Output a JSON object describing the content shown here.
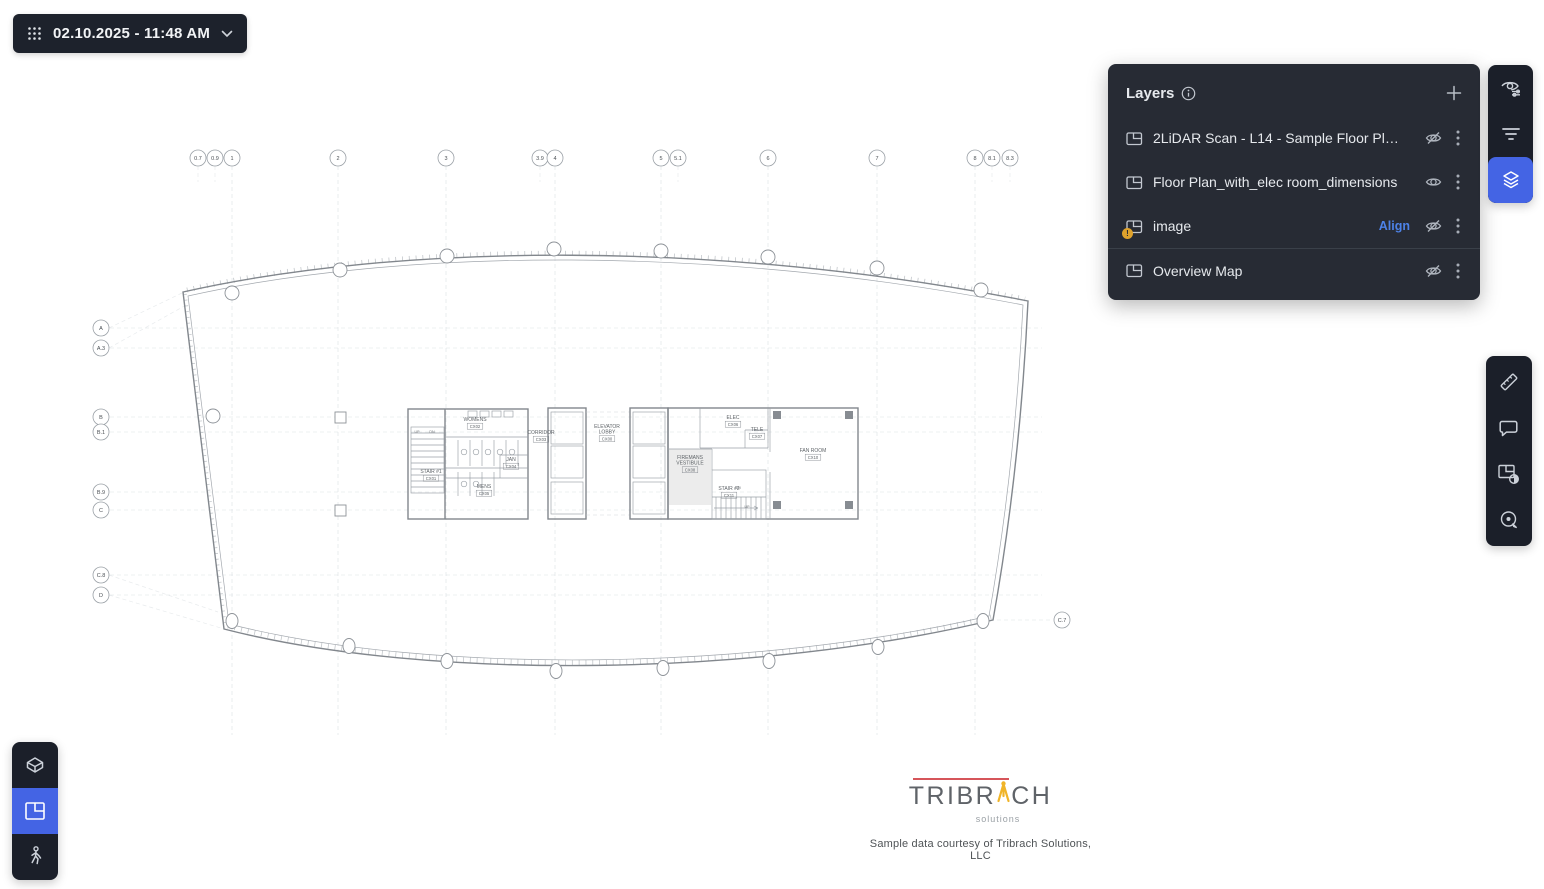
{
  "datebar": {
    "label": "02.10.2025 - 11:48 AM",
    "grid_icon": "grid-dots-icon",
    "chevron_icon": "chevron-down-icon"
  },
  "layers_panel": {
    "title": "Layers",
    "info_icon": "info-icon",
    "add_icon": "plus-icon",
    "items": [
      {
        "name": "2LiDAR Scan - L14 - Sample Floor Plan.76",
        "visible": false
      },
      {
        "name": "Floor Plan_with_elec room_dimensions",
        "visible": true
      },
      {
        "name": "image",
        "visible": false,
        "warning": true,
        "action_label": "Align"
      },
      {
        "name": "Overview Map",
        "visible": false
      }
    ]
  },
  "right_toolbar_top": {
    "items": [
      {
        "icon": "view-settings-icon",
        "active": false
      },
      {
        "icon": "filter-icon",
        "active": false
      },
      {
        "icon": "layers-icon",
        "active": true
      }
    ]
  },
  "right_toolbar_tools": {
    "items": [
      {
        "icon": "measure-icon"
      },
      {
        "icon": "comment-icon"
      },
      {
        "icon": "compare-icon"
      },
      {
        "icon": "annotate-icon"
      }
    ]
  },
  "left_toolbar": {
    "items": [
      {
        "icon": "view-3d-icon",
        "active": false
      },
      {
        "icon": "floor-plan-icon",
        "active": true
      },
      {
        "icon": "walkthrough-icon",
        "active": false
      }
    ]
  },
  "logo": {
    "brand_left": "TRIBR",
    "brand_right": "CH",
    "sub": "solutions",
    "caption": "Sample data courtesy of Tribrach Solutions, LLC",
    "tripod_icon": "tripod-icon"
  },
  "colors": {
    "accent_blue": "#4464e4",
    "warning_amber": "#dfa22c",
    "align_link": "#4d82e8",
    "panel_dark": "#272b34",
    "toolbar_dark": "#1b1f29"
  },
  "floorplan": {
    "top_bubble_y": 158,
    "left_bubble_x": 101,
    "grid_top": [
      {
        "label": "0.7",
        "x": 198
      },
      {
        "label": "0.9",
        "x": 215
      },
      {
        "label": "1",
        "x": 232
      },
      {
        "label": "2",
        "x": 338
      },
      {
        "label": "3",
        "x": 446
      },
      {
        "label": "3.9",
        "x": 540
      },
      {
        "label": "4",
        "x": 555
      },
      {
        "label": "5",
        "x": 661
      },
      {
        "label": "5.1",
        "x": 678
      },
      {
        "label": "6",
        "x": 768
      },
      {
        "label": "7",
        "x": 877
      },
      {
        "label": "8",
        "x": 975
      },
      {
        "label": "8.1",
        "x": 992
      },
      {
        "label": "8.3",
        "x": 1010
      }
    ],
    "grid_left": [
      {
        "label": "A",
        "y": 328
      },
      {
        "label": "A.3",
        "y": 348
      },
      {
        "label": "B",
        "y": 417
      },
      {
        "label": "B.1",
        "y": 432
      },
      {
        "label": "B.9",
        "y": 492
      },
      {
        "label": "C",
        "y": 510
      },
      {
        "label": "C.8",
        "y": 575
      },
      {
        "label": "D",
        "y": 595
      }
    ],
    "extra_bubble": {
      "label": "C.7",
      "x": 1062,
      "y": 620
    },
    "rooms": [
      {
        "lines": [
          "WOMENS"
        ],
        "code": "CX02",
        "x": 475,
        "y": 421
      },
      {
        "lines": [
          "STAIR #1"
        ],
        "code": "CX01",
        "x": 431,
        "y": 473
      },
      {
        "lines": [
          "MENS"
        ],
        "code": "CX05",
        "x": 484,
        "y": 488
      },
      {
        "lines": [
          "JAN"
        ],
        "code": "CX04",
        "x": 511,
        "y": 461
      },
      {
        "lines": [
          "CORRIDOR"
        ],
        "code": "CX03",
        "x": 541,
        "y": 434
      },
      {
        "lines": [
          "ELEVATOR",
          "LOBBY"
        ],
        "code": "CX00",
        "x": 607,
        "y": 428
      },
      {
        "lines": [
          "ELEC"
        ],
        "code": "CX06",
        "x": 733,
        "y": 419
      },
      {
        "lines": [
          "TELE"
        ],
        "code": "CX07",
        "x": 757,
        "y": 431
      },
      {
        "lines": [
          "FIREMANS",
          "VESTIBULE"
        ],
        "code": "CX08",
        "x": 690,
        "y": 459
      },
      {
        "lines": [
          "STAIR #2"
        ],
        "code": "CX11",
        "x": 729,
        "y": 490
      },
      {
        "lines": [
          "FAN ROOM"
        ],
        "code": "CX10",
        "x": 813,
        "y": 452
      }
    ],
    "annotations": [
      {
        "t": "UP",
        "x": 417,
        "y": 433
      },
      {
        "t": "DN",
        "x": 432,
        "y": 433
      },
      {
        "t": "DN",
        "x": 738,
        "y": 489
      },
      {
        "t": "UP",
        "x": 747,
        "y": 508
      }
    ]
  }
}
